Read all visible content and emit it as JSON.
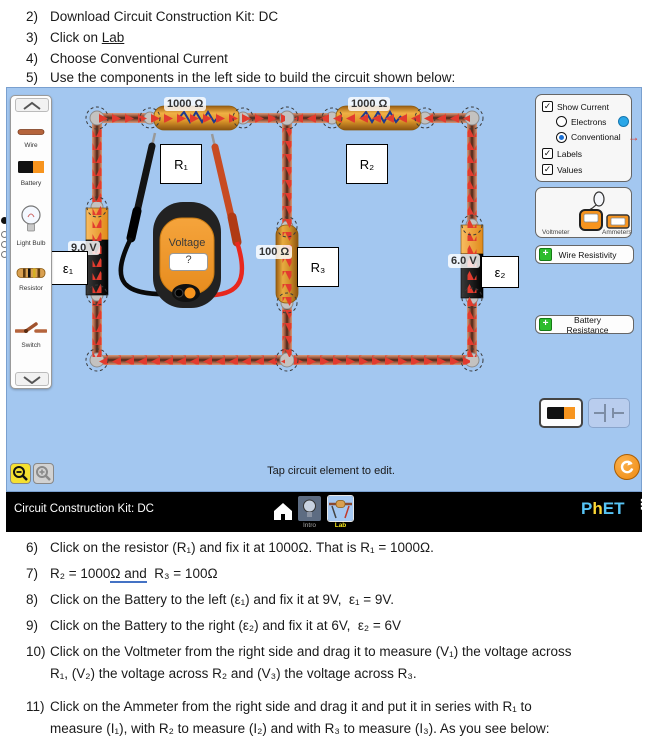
{
  "doc": {
    "top_items": [
      {
        "num": "2)",
        "text": "Download Circuit Construction Kit: DC"
      },
      {
        "num": "3)",
        "pre": "Click on ",
        "link": "Lab"
      },
      {
        "num": "4)",
        "text": "Choose Conventional Current"
      },
      {
        "num": "5)",
        "text": "Use the components in the left side to build the circuit shown below:"
      }
    ],
    "bottom_items": [
      {
        "num": "6)",
        "text": "Click on the resistor (R₁) and fix it at 1000Ω. That is R₁ = 1000Ω."
      },
      {
        "num": "7)",
        "pre": "R₂ = 1000",
        "underlined": "Ω and",
        "post": "  R₃ = 100Ω"
      },
      {
        "num": "8)",
        "text": "Click on the Battery to the left (ε₁) and fix it at 9V,  ε₁ = 9V."
      },
      {
        "num": "9)",
        "text": "Click on the Battery to the right (ε₂) and fix it at 6V,  ε₂ = 6V"
      },
      {
        "num": "10)",
        "line1": "Click on the Voltmeter from the right side and drag it to measure (V₁) the voltage across",
        "line2": "R₁, (V₂) the voltage across R₂ and (V₃) the voltage across R₃."
      },
      {
        "num": "11)",
        "line1": "Click on the Ammeter from the right side and drag it and put it in series with R₁ to",
        "line2": "measure (I₁), with R₂ to measure (I₂) and with R₃ to measure (I₃). As you see below:"
      }
    ]
  },
  "sim": {
    "toolbox": {
      "items": [
        {
          "label": "Wire"
        },
        {
          "label": "Battery"
        },
        {
          "label": "Light Bulb"
        },
        {
          "label": "Resistor"
        },
        {
          "label": "Switch"
        }
      ]
    },
    "controls": {
      "show_current": "Show Current",
      "electrons": "Electrons",
      "conventional": "Conventional",
      "labels": "Labels",
      "values": "Values",
      "voltmeter": "Voltmeter",
      "ammeters": "Ammeters",
      "wire_resistivity": "Wire Resistivity",
      "battery_resistance": "Battery Resistance"
    },
    "circuit": {
      "r1_value": "1000 Ω",
      "r2_value": "1000 Ω",
      "r3_value": "100 Ω",
      "batt1_value": "9.0 V",
      "batt2_value": "6.0 V",
      "r1_label": "R₁",
      "r2_label": "R₂",
      "r3_label": "R₃",
      "eps1_label": "ε₁",
      "eps2_label": "ε₂",
      "voltmeter_title": "Voltage",
      "voltmeter_reading": "?"
    },
    "status": "Tap circuit element to edit.",
    "navbar": {
      "title": "Circuit Construction Kit: DC",
      "tab_intro": "Intro",
      "tab_lab": "Lab",
      "logo_p": "P",
      "logo_h": "h",
      "logo_et": "ET"
    },
    "icons": {
      "check": "✓",
      "plus": "+",
      "arrow_right": "→",
      "menu": "⋮"
    },
    "colors": {
      "sim_bg": "#a3c7f0",
      "accent_orange": "#f7941e",
      "arrow_red": "#e23b2e",
      "wire_copper": "#8a4a30"
    }
  }
}
